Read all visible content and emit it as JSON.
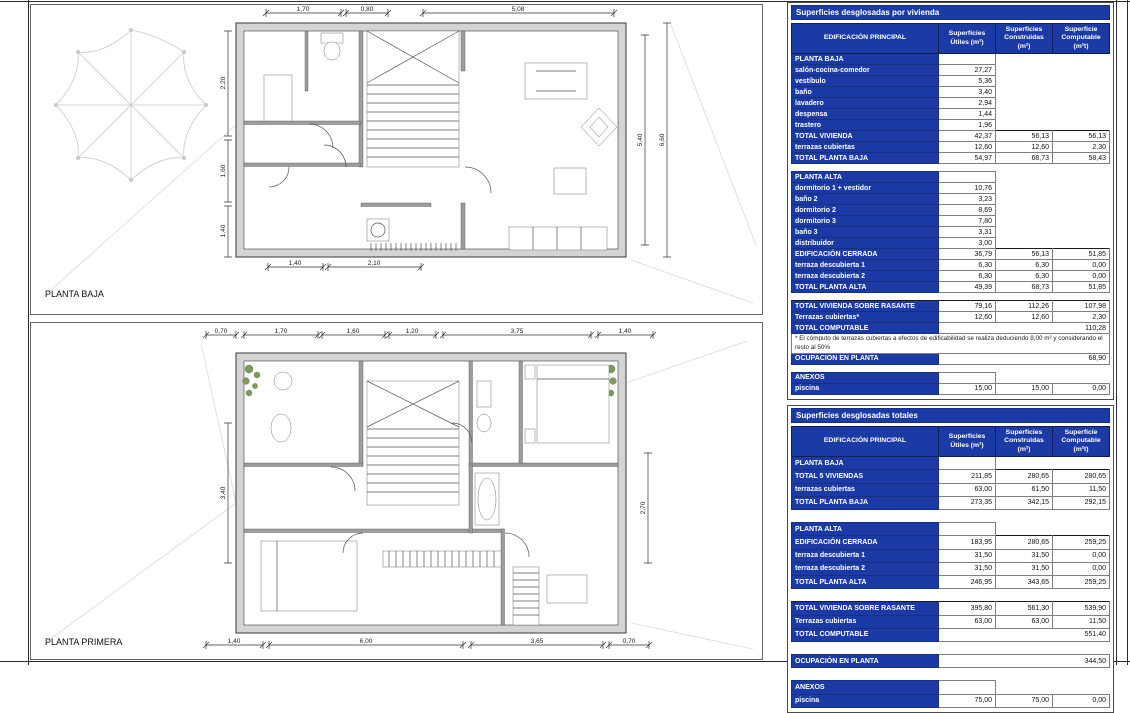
{
  "plans": {
    "planta_baja": {
      "label": "PLANTA BAJA",
      "dims_top": [
        "1,70",
        "0,80",
        "5,08"
      ],
      "dims_bottom": [
        "1,40",
        "2,10"
      ],
      "dims_left": [
        "2,20",
        "1,60",
        "1,40"
      ],
      "dims_right": [
        "5,40",
        "6,60"
      ]
    },
    "planta_primera": {
      "label": "PLANTA PRIMERA",
      "dims_top": [
        "0,70",
        "1,70",
        "1,60",
        "1,20",
        "3,75",
        "1,40"
      ],
      "dims_bottom": [
        "1,40",
        "6,00",
        "3,65",
        "0,70"
      ],
      "dims_left": [
        "3,40"
      ],
      "dims_right": [
        "2,70"
      ]
    }
  },
  "colors": {
    "table_header_blue": "#1b3aa6",
    "wall_gray": "#d4d4d4"
  },
  "tables": [
    {
      "title": "Superficies desglosadas por vivienda",
      "columns": [
        "EDIFICACIÓN PRINCIPAL",
        "Superficies Útiles (m²)",
        "Superficies Construidas (m²)",
        "Superficie Computable (m²t)"
      ],
      "rows": [
        {
          "type": "section",
          "label": "PLANTA BAJA",
          "c1": "",
          "c2": "",
          "c3": ""
        },
        {
          "type": "data",
          "label": "salón-cocina-comedor",
          "c1": "27,27",
          "c2": "",
          "c3": ""
        },
        {
          "type": "data",
          "label": "vestíbulo",
          "c1": "5,36",
          "c2": "",
          "c3": ""
        },
        {
          "type": "data",
          "label": "baño",
          "c1": "3,40",
          "c2": "",
          "c3": ""
        },
        {
          "type": "data",
          "label": "lavadero",
          "c1": "2,94",
          "c2": "",
          "c3": ""
        },
        {
          "type": "data",
          "label": "despensa",
          "c1": "1,44",
          "c2": "",
          "c3": ""
        },
        {
          "type": "data",
          "label": "trastero",
          "c1": "1,96",
          "c2": "",
          "c3": ""
        },
        {
          "type": "total",
          "label": "TOTAL VIVIENDA",
          "c1": "42,37",
          "c2": "56,13",
          "c3": "56,13"
        },
        {
          "type": "data",
          "label": "terrazas cubiertas",
          "c1": "12,60",
          "c2": "12,60",
          "c3": "2,30"
        },
        {
          "type": "total",
          "label": "TOTAL PLANTA BAJA",
          "c1": "54,97",
          "c2": "68,73",
          "c3": "58,43"
        },
        {
          "type": "spacer"
        },
        {
          "type": "section",
          "label": "PLANTA ALTA",
          "c1": "",
          "c2": "",
          "c3": ""
        },
        {
          "type": "data",
          "label": "dormitorio 1 + vestidor",
          "c1": "10,76",
          "c2": "",
          "c3": ""
        },
        {
          "type": "data",
          "label": "baño 2",
          "c1": "3,23",
          "c2": "",
          "c3": ""
        },
        {
          "type": "data",
          "label": "dormitorio 2",
          "c1": "8,69",
          "c2": "",
          "c3": ""
        },
        {
          "type": "data",
          "label": "dormitorio 3",
          "c1": "7,80",
          "c2": "",
          "c3": ""
        },
        {
          "type": "data",
          "label": "baño 3",
          "c1": "3,31",
          "c2": "",
          "c3": ""
        },
        {
          "type": "data",
          "label": "distribuidor",
          "c1": "3,00",
          "c2": "",
          "c3": ""
        },
        {
          "type": "total",
          "label": "EDIFICACIÓN CERRADA",
          "c1": "36,79",
          "c2": "56,13",
          "c3": "51,85"
        },
        {
          "type": "data",
          "label": "terraza descubierta 1",
          "c1": "6,30",
          "c2": "6,30",
          "c3": "0,00"
        },
        {
          "type": "data",
          "label": "terraza descubierta 2",
          "c1": "6,30",
          "c2": "6,30",
          "c3": "0,00"
        },
        {
          "type": "total",
          "label": "TOTAL PLANTA ALTA",
          "c1": "49,39",
          "c2": "68,73",
          "c3": "51,85"
        },
        {
          "type": "spacer"
        },
        {
          "type": "total",
          "label": "TOTAL VIVIENDA SOBRE RASANTE",
          "c1": "79,16",
          "c2": "112,26",
          "c3": "107,98"
        },
        {
          "type": "data",
          "label": "Terrazas cubiertas*",
          "c1": "12,60",
          "c2": "12,60",
          "c3": "2,30"
        },
        {
          "type": "wide",
          "label": "TOTAL COMPUTABLE",
          "value": "110,28"
        },
        {
          "type": "note",
          "text": "* El cómputo de terrazas cubiertas a efectos de edificabilidad se realiza deduciendo 8,00 m² y considerando el resto al 50%"
        },
        {
          "type": "wide",
          "label": "OCUPACIÓN EN PLANTA",
          "value": "68,90"
        },
        {
          "type": "spacer"
        },
        {
          "type": "section",
          "label": "ANEXOS",
          "c1": "",
          "c2": "",
          "c3": ""
        },
        {
          "type": "data",
          "label": "piscina",
          "c1": "15,00",
          "c2": "15,00",
          "c3": "0,00"
        }
      ]
    },
    {
      "title": "Superficies desglosadas totales",
      "columns": [
        "EDIFICACIÓN PRINCIPAL",
        "Superficies Útiles (m²)",
        "Superficies Construidas (m²)",
        "Superficie Computable (m²t)"
      ],
      "rows": [
        {
          "type": "section",
          "label": "PLANTA BAJA",
          "c1": "",
          "c2": "",
          "c3": ""
        },
        {
          "type": "total",
          "label": "TOTAL 5 VIVIENDAS",
          "c1": "211,85",
          "c2": "280,65",
          "c3": "280,65"
        },
        {
          "type": "data",
          "label": "terrazas cubiertas",
          "c1": "63,00",
          "c2": "61,50",
          "c3": "11,50"
        },
        {
          "type": "total",
          "label": "TOTAL PLANTA BAJA",
          "c1": "273,35",
          "c2": "342,15",
          "c3": "292,15"
        },
        {
          "type": "spacer"
        },
        {
          "type": "section",
          "label": "PLANTA ALTA",
          "c1": "",
          "c2": "",
          "c3": ""
        },
        {
          "type": "total",
          "label": "EDIFICACIÓN CERRADA",
          "c1": "183,95",
          "c2": "280,65",
          "c3": "259,25"
        },
        {
          "type": "data",
          "label": "terraza descubierta 1",
          "c1": "31,50",
          "c2": "31,50",
          "c3": "0,00"
        },
        {
          "type": "data",
          "label": "terraza descubierta 2",
          "c1": "31,50",
          "c2": "31,50",
          "c3": "0,00"
        },
        {
          "type": "total",
          "label": "TOTAL PLANTA ALTA",
          "c1": "246,95",
          "c2": "343,65",
          "c3": "259,25"
        },
        {
          "type": "spacer"
        },
        {
          "type": "total",
          "label": "TOTAL VIVIENDA SOBRE RASANTE",
          "c1": "395,80",
          "c2": "561,30",
          "c3": "539,90"
        },
        {
          "type": "data",
          "label": "Terrazas cubiertas",
          "c1": "63,00",
          "c2": "63,00",
          "c3": "11,50"
        },
        {
          "type": "wide",
          "label": "TOTAL COMPUTABLE",
          "value": "551,40"
        },
        {
          "type": "spacer"
        },
        {
          "type": "wide",
          "label": "OCUPACIÓN EN PLANTA",
          "value": "344,50"
        },
        {
          "type": "spacer"
        },
        {
          "type": "section",
          "label": "ANEXOS",
          "c1": "",
          "c2": "",
          "c3": ""
        },
        {
          "type": "data",
          "label": "piscina",
          "c1": "75,00",
          "c2": "75,00",
          "c3": "0,00"
        }
      ]
    }
  ]
}
